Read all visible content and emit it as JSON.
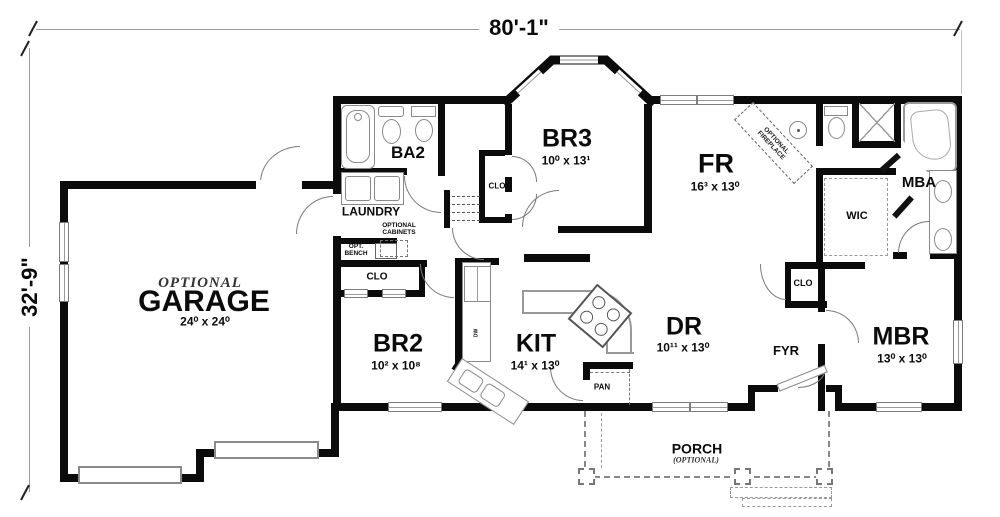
{
  "dim": {
    "width": "80'-1\"",
    "height": "32'-9\""
  },
  "labels": {
    "clo": "CLO",
    "dn": "DN",
    "dw": "DW",
    "pan": "PAN",
    "opt_cabinets": "OPTIONAL\nCABINETS",
    "opt_bench": "OPT.\nBENCH",
    "fireplace": "OPTIONAL\nFIREPLACE"
  },
  "rooms": {
    "garage": {
      "qualifier": "OPTIONAL",
      "name": "GARAGE",
      "size": "24⁰ x 24⁰"
    },
    "ba2": {
      "name": "BA2"
    },
    "laundry": {
      "name": "LAUNDRY"
    },
    "br3": {
      "name": "BR3",
      "size": "10⁰ x 13¹"
    },
    "fr": {
      "name": "FR",
      "size": "16³ x 13⁰"
    },
    "mba": {
      "name": "MBA"
    },
    "wic": {
      "name": "WIC"
    },
    "br2": {
      "name": "BR2",
      "size": "10² x 10⁸"
    },
    "kit": {
      "name": "KIT",
      "size": "14¹ x 13⁰"
    },
    "dr": {
      "name": "DR",
      "size": "10¹¹ x 13⁰"
    },
    "fyr": {
      "name": "FYR"
    },
    "mbr": {
      "name": "MBR",
      "size": "13⁰ x 13⁰"
    },
    "porch": {
      "name": "PORCH",
      "qualifier": "(OPTIONAL)"
    }
  }
}
